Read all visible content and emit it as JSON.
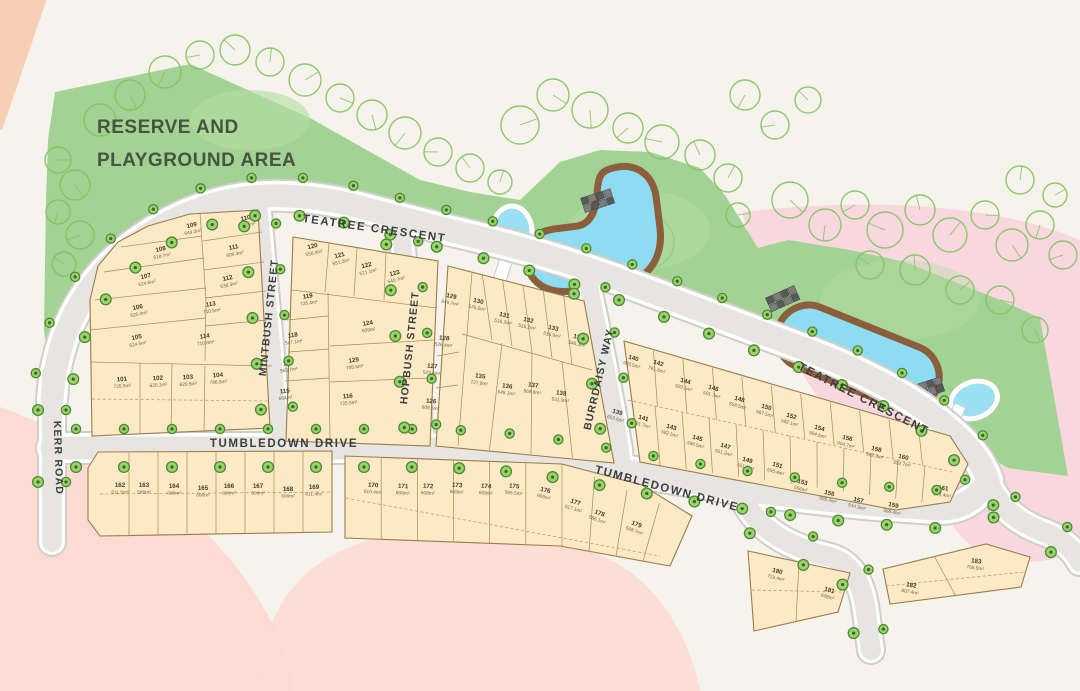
{
  "plan": {
    "reserve": {
      "line1": "RESERVE AND",
      "line2": "PLAYGROUND AREA"
    },
    "streets": {
      "kerr": "KERR ROAD",
      "teatree": "TEATREE CRESCENT",
      "mintbush": "MINTBUSH STREET",
      "hopbush": "HOPBUSH STREET",
      "burrdaisy": "BURRDAISY WAY",
      "tumbledown": "TUMBLEDOWN DRIVE"
    },
    "lots": [
      {
        "num": "101",
        "area": "725.5m²"
      },
      {
        "num": "102",
        "area": "620.3m²"
      },
      {
        "num": "103",
        "area": "620.5m²"
      },
      {
        "num": "104",
        "area": "786.5m²"
      },
      {
        "num": "105",
        "area": "624.5m²"
      },
      {
        "num": "106",
        "area": "625.4m²"
      },
      {
        "num": "107",
        "area": "624.6m²"
      },
      {
        "num": "108",
        "area": "618.7m²"
      },
      {
        "num": "109",
        "area": "644.3m²"
      },
      {
        "num": "110",
        "area": "636.5m²"
      },
      {
        "num": "111",
        "area": "609.3m²"
      },
      {
        "num": "112",
        "area": "638.3m²"
      },
      {
        "num": "113",
        "area": "710.5m²"
      },
      {
        "num": "114",
        "area": "710.8m²"
      },
      {
        "num": "115",
        "area": "604m²"
      },
      {
        "num": "116",
        "area": "725.5m²"
      },
      {
        "num": "117",
        "area": "565.7m²"
      },
      {
        "num": "118",
        "area": "547.1m²"
      },
      {
        "num": "119",
        "area": "726.4m²"
      },
      {
        "num": "120",
        "area": "556.4m²"
      },
      {
        "num": "121",
        "area": "551.3m²"
      },
      {
        "num": "122",
        "area": "521.1m²"
      },
      {
        "num": "123",
        "area": "540.7m²"
      },
      {
        "num": "124",
        "area": "609m²"
      },
      {
        "num": "125",
        "area": "705.6m²"
      },
      {
        "num": "126",
        "area": "609.5m²"
      },
      {
        "num": "127",
        "area": "523.4m²"
      },
      {
        "num": "128",
        "area": "526.4m²"
      },
      {
        "num": "129",
        "area": "849.7m²"
      },
      {
        "num": "130",
        "area": "576.5m²"
      },
      {
        "num": "131",
        "area": "516.2m²"
      },
      {
        "num": "132",
        "area": "516.2m²"
      },
      {
        "num": "133",
        "area": "516.9m²"
      },
      {
        "num": "134",
        "area": "546.3m²"
      },
      {
        "num": "135",
        "area": "727.8m²"
      },
      {
        "num": "136",
        "area": "645.1m²"
      },
      {
        "num": "137",
        "area": "569.8m²"
      },
      {
        "num": "138",
        "area": "531.9m²"
      },
      {
        "num": "139",
        "area": "653.6m²"
      },
      {
        "num": "140",
        "area": "903.5m²"
      },
      {
        "num": "141",
        "area": "591.7m²"
      },
      {
        "num": "142",
        "area": "761.6m²"
      },
      {
        "num": "143",
        "area": "582.5m²"
      },
      {
        "num": "144",
        "area": "503.5m²"
      },
      {
        "num": "145",
        "area": "566.5m²"
      },
      {
        "num": "146",
        "area": "501.7m²"
      },
      {
        "num": "147",
        "area": "551.2m²"
      },
      {
        "num": "148",
        "area": "558.5m²"
      },
      {
        "num": "149",
        "area": "551.5m²"
      },
      {
        "num": "150",
        "area": "587.5m²"
      },
      {
        "num": "151",
        "area": "555.4m²"
      },
      {
        "num": "152",
        "area": "582.1m²"
      },
      {
        "num": "153",
        "area": "556m²"
      },
      {
        "num": "154",
        "area": "904.5m²"
      },
      {
        "num": "155",
        "area": "905.4m²"
      },
      {
        "num": "156",
        "area": "904.7m²"
      },
      {
        "num": "157",
        "area": "544.3m²"
      },
      {
        "num": "158",
        "area": "582.3m²"
      },
      {
        "num": "159",
        "area": "568.4m²"
      },
      {
        "num": "160",
        "area": "592.7m²"
      },
      {
        "num": "161",
        "area": "673.4m²"
      },
      {
        "num": "162",
        "area": "511.5m²"
      },
      {
        "num": "163",
        "area": "588m²"
      },
      {
        "num": "164",
        "area": "608m²"
      },
      {
        "num": "165",
        "area": "608m²"
      },
      {
        "num": "166",
        "area": "608m²"
      },
      {
        "num": "167",
        "area": "608m²"
      },
      {
        "num": "168",
        "area": "608m²"
      },
      {
        "num": "169",
        "area": "611.4m²"
      },
      {
        "num": "170",
        "area": "610.4m²"
      },
      {
        "num": "171",
        "area": "608m²"
      },
      {
        "num": "172",
        "area": "608m²"
      },
      {
        "num": "173",
        "area": "608m²"
      },
      {
        "num": "174",
        "area": "608m²"
      },
      {
        "num": "175",
        "area": "565.5m²"
      },
      {
        "num": "176",
        "area": "608m²"
      },
      {
        "num": "177",
        "area": "517.1m²"
      },
      {
        "num": "178",
        "area": "586.1m²"
      },
      {
        "num": "179",
        "area": "568.7m²"
      },
      {
        "num": "180",
        "area": "723.4m²"
      },
      {
        "num": "181",
        "area": "608m²"
      },
      {
        "num": "182",
        "area": "607.4m²"
      },
      {
        "num": "183",
        "area": "765.5m²"
      }
    ],
    "colors": {
      "reserve_green": "#a3d394",
      "water_blue": "#8edcf2",
      "lot_fill": "#fce9c6",
      "road_gray": "#e7e5e2",
      "pink_wash": "#fbdbd3",
      "rose_wash": "#f9d7df",
      "pond_bank": "#8b5e3c",
      "street_tree": "#9ed06b"
    }
  }
}
